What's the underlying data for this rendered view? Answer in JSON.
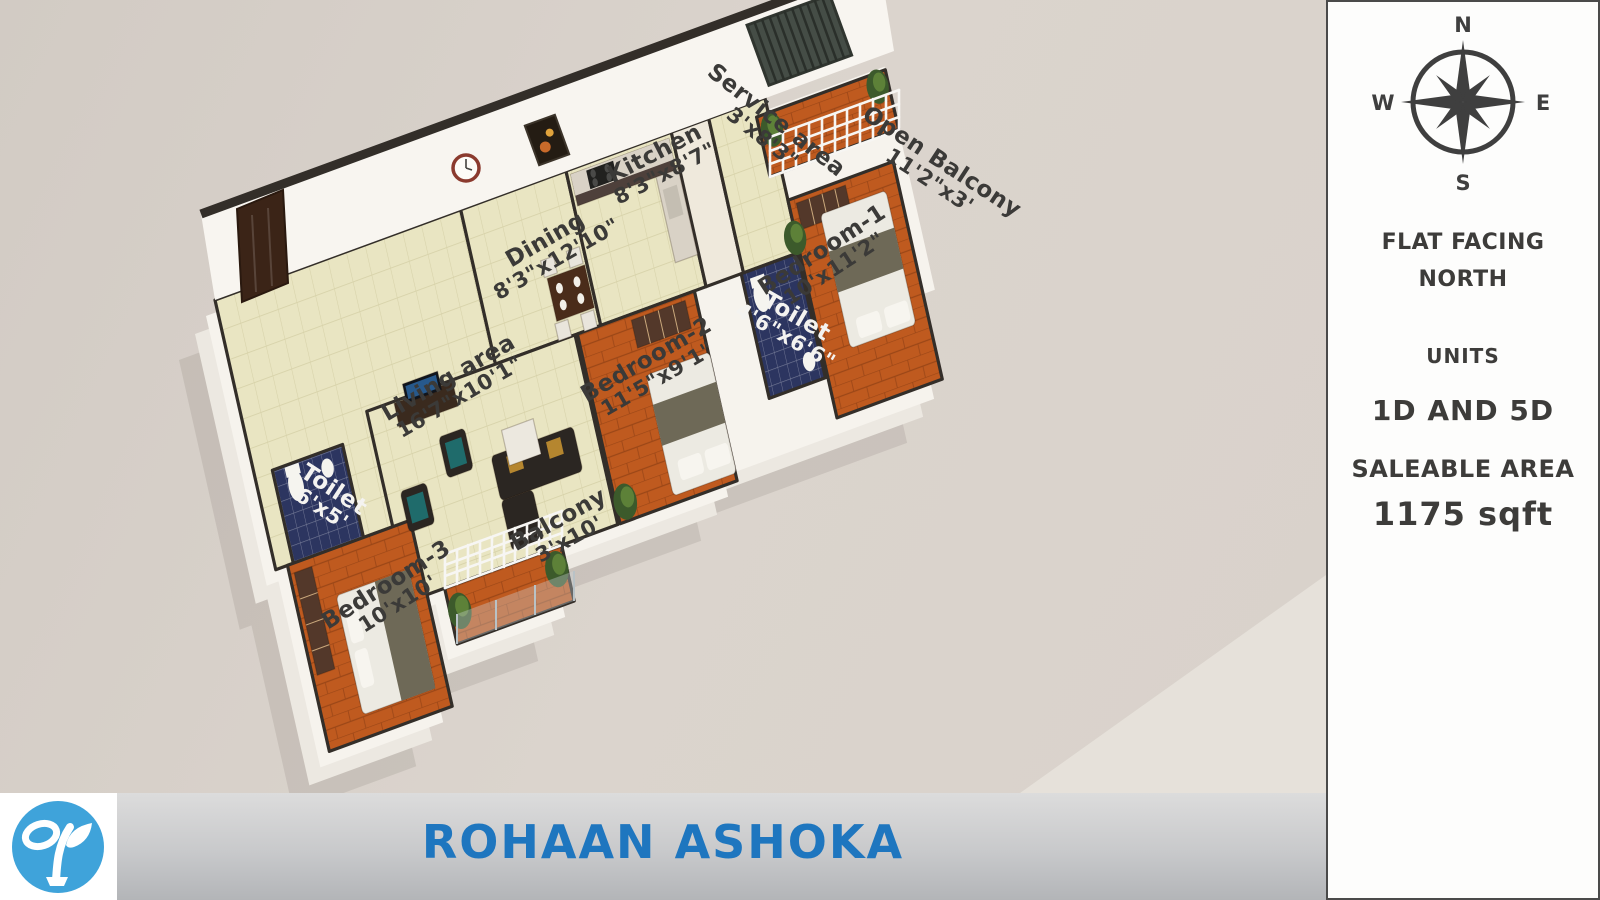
{
  "rooms": [
    {
      "name": "Kitchen",
      "dims": "8'3\"x8'7\""
    },
    {
      "name": "Service area",
      "dims": "3'x8'3\""
    },
    {
      "name": "Dining",
      "dims": "8'3\"x12'10\""
    },
    {
      "name": "Open Balcony",
      "dims": "11'2\"x3'"
    },
    {
      "name": "Bedroom-1",
      "dims": "10'x11'2\""
    },
    {
      "name": "Toilet",
      "dims": "4'6\"x6'6\""
    },
    {
      "name": "Bedroom-2",
      "dims": "11'5\"x9'1\""
    },
    {
      "name": "Living area",
      "dims": "16'7\"x10'1\""
    },
    {
      "name": "Toilet",
      "dims": "6'x5'"
    },
    {
      "name": "Balcony",
      "dims": "3'x10'"
    },
    {
      "name": "Bedroom-3",
      "dims": "10'x10'"
    }
  ],
  "compass": {
    "n": "N",
    "e": "E",
    "s": "S",
    "w": "W"
  },
  "sidebar": {
    "facing_line1": "FLAT FACING",
    "facing_line2": "NORTH",
    "units_label": "UNITS",
    "units_value": "1D AND 5D",
    "area_label": "SALEABLE AREA",
    "area_value": "1175 sqft"
  },
  "footer": {
    "title": "ROHAAN ASHOKA"
  },
  "colors": {
    "accent_blue": "#1e76bf",
    "logo_blue": "#3fa3da",
    "wall_dark": "#332e29",
    "floor_tile": "#e9e5c2",
    "floor_wood": "#bf5a1f",
    "floor_toilet": "#2c3560"
  }
}
